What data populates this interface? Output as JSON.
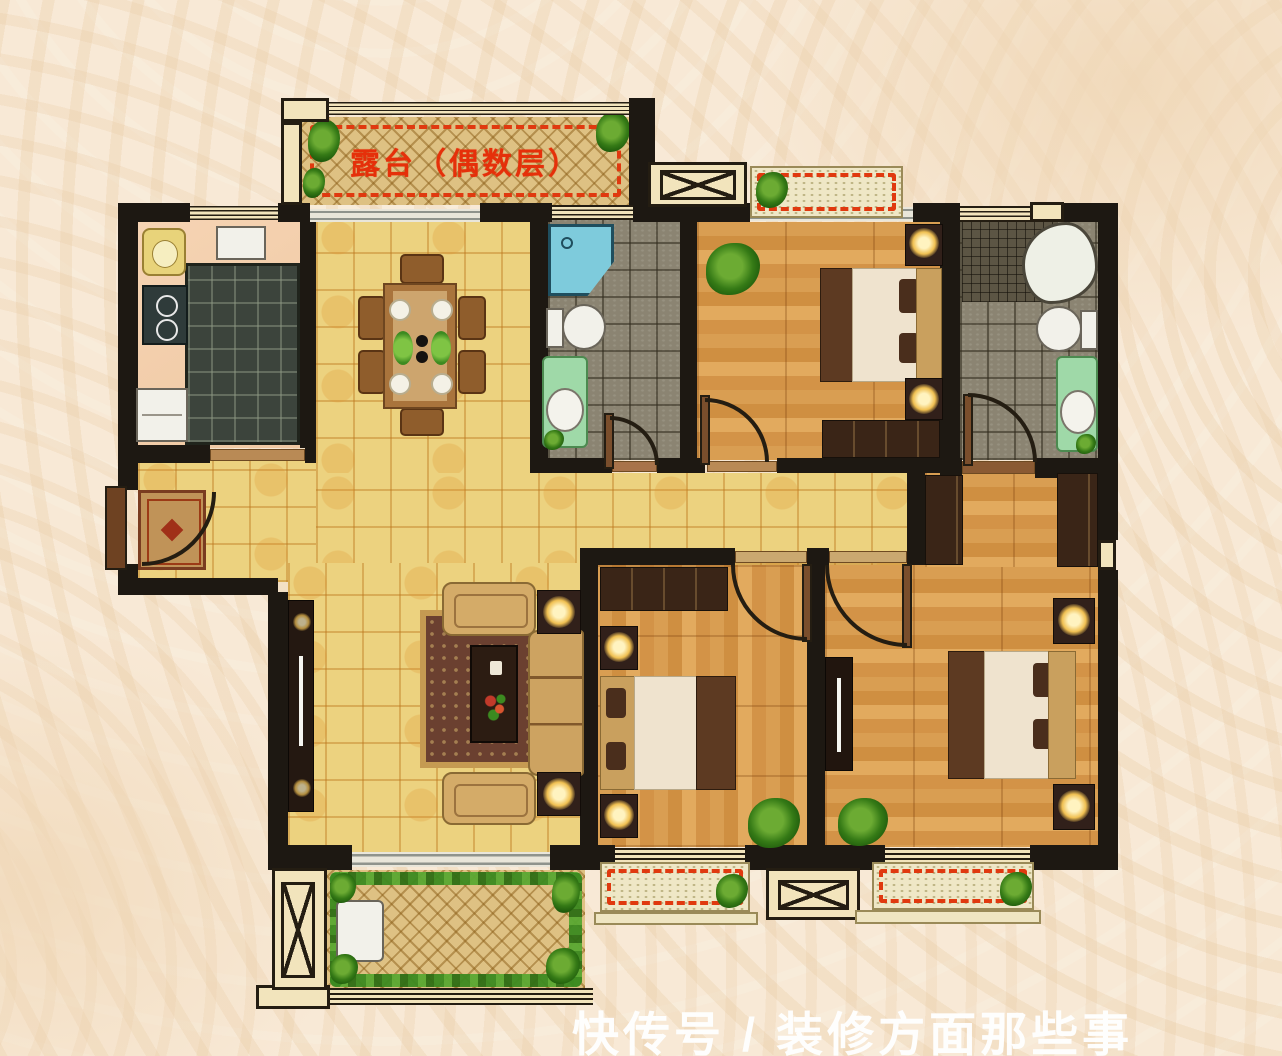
{
  "terrace": {
    "label": "露台（偶数层）"
  },
  "watermark": {
    "text": "快传号 / 装修方面那些事"
  },
  "palette": {
    "background": "#f8e9d6",
    "wall": "#1d1812",
    "window_fill": "#f2e4bc",
    "tile_floor": "#ecd27f",
    "wood_floor": "#d3944a",
    "bath_floor": "#8b8472",
    "kitchen_floor": "#f4cfae",
    "terrace_floor": "#dec183",
    "accent_red_dash": "#e0390f",
    "terrace_label_red": "#e5300a",
    "plant_green": "#3c8a20",
    "shower_blue": "#79c8d8",
    "watermark_white": "#ffffff"
  }
}
